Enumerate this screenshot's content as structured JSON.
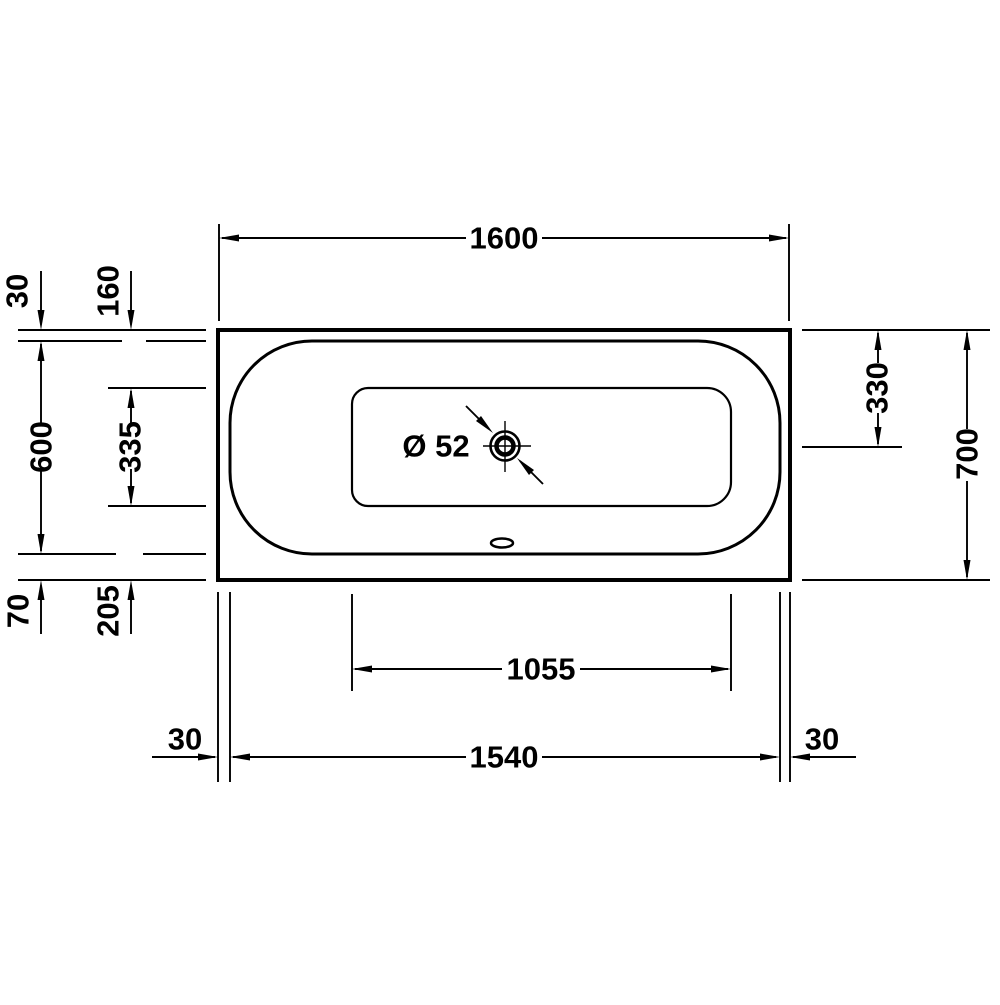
{
  "page": {
    "background": "#ffffff",
    "line_color": "#000000",
    "description": "Technical dimension drawing of a bathtub, top view"
  },
  "drawing": {
    "labels": {
      "overall_length": "1600",
      "overall_width": "700",
      "inner_length": "1540",
      "floor_length": "1055",
      "rim_top": "30",
      "rim_bottom": "70",
      "rim_end_left": "30",
      "rim_end_right": "30",
      "floor_top_offset": "160",
      "inner_width": "600",
      "floor_width": "335",
      "floor_bottom_offset": "205",
      "drain_center_offset": "330",
      "drain_diameter": "Ø 52"
    }
  }
}
